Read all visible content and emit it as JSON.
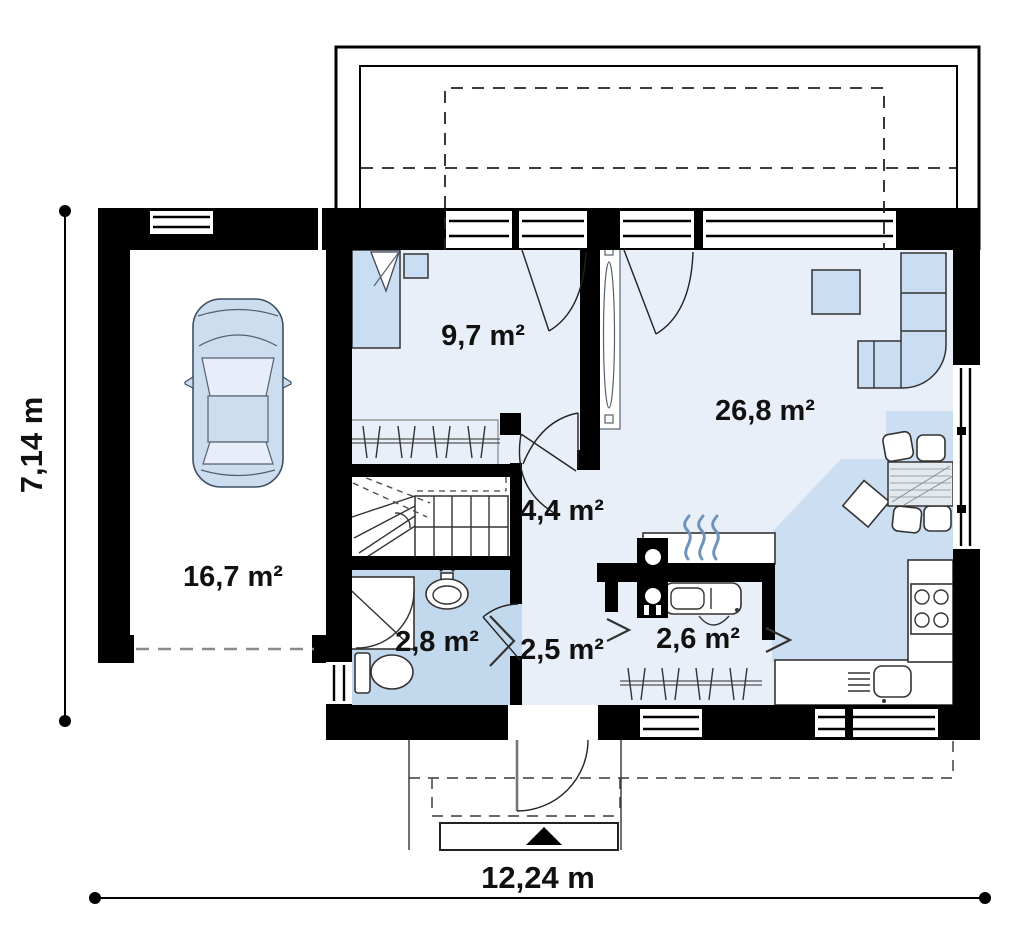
{
  "rooms": {
    "garage": {
      "area": "16,7 m²"
    },
    "bedroom": {
      "area": "9,7 m²"
    },
    "living_room": {
      "area": "26,8 m²"
    },
    "hall": {
      "area": "4,4 m²"
    },
    "bathroom": {
      "area": "2,8 m²"
    },
    "entry_hall": {
      "area": "2,5 m²"
    },
    "wardrobe": {
      "area": "2,6 m²"
    }
  },
  "dimensions": {
    "total_width": "12,24 m",
    "total_depth": "7,14 m"
  },
  "colors": {
    "wall": "#000000",
    "floor": "#e9eff8",
    "floor_wet": "#c2d8ec",
    "floor_kitchen": "#ccdef2",
    "furniture": "#c9ddf3",
    "dash_gray": "#8a8a8a"
  }
}
